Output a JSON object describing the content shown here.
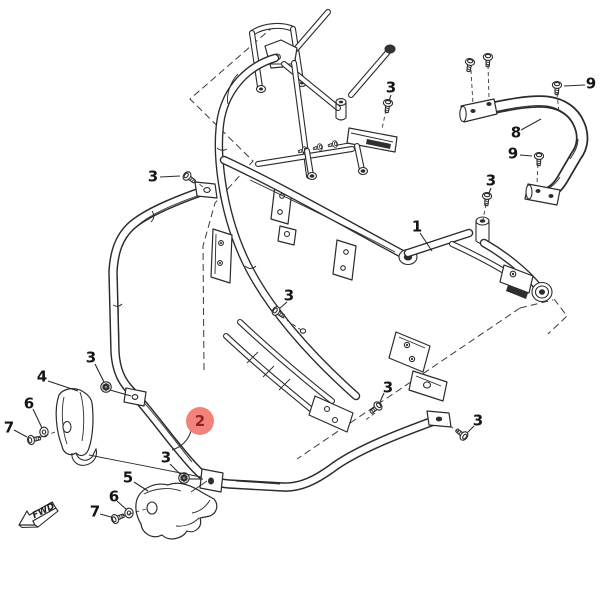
{
  "diagram": {
    "kind": "exploded-parts-diagram",
    "description": "Vehicle frame and front bumper exploded parts diagram",
    "background_color": "#ffffff",
    "line_color": "#2b2b2b",
    "highlight_circle_color": "#f2827b",
    "highlight_text_color": "#8f2323",
    "label_text_color": "#151515"
  },
  "fwd_arrow": {
    "label": "FWD"
  },
  "highlighted_part": "2",
  "callouts": [
    {
      "id": "1",
      "label": "1",
      "x": 417,
      "y": 227,
      "highlighted": false
    },
    {
      "id": "2",
      "label": "2",
      "x": 200,
      "y": 421,
      "highlighted": true
    },
    {
      "id": "3a",
      "label": "3",
      "x": 153,
      "y": 177,
      "highlighted": false
    },
    {
      "id": "3b",
      "label": "3",
      "x": 391,
      "y": 88,
      "highlighted": false
    },
    {
      "id": "3c",
      "label": "3",
      "x": 289,
      "y": 296,
      "highlighted": false
    },
    {
      "id": "3d",
      "label": "3",
      "x": 91,
      "y": 358,
      "highlighted": false
    },
    {
      "id": "3e",
      "label": "3",
      "x": 166,
      "y": 458,
      "highlighted": false
    },
    {
      "id": "3f",
      "label": "3",
      "x": 388,
      "y": 388,
      "highlighted": false
    },
    {
      "id": "3g",
      "label": "3",
      "x": 478,
      "y": 421,
      "highlighted": false
    },
    {
      "id": "3h",
      "label": "3",
      "x": 491,
      "y": 181,
      "highlighted": false
    },
    {
      "id": "4",
      "label": "4",
      "x": 42,
      "y": 377,
      "highlighted": false
    },
    {
      "id": "5",
      "label": "5",
      "x": 128,
      "y": 478,
      "highlighted": false
    },
    {
      "id": "6a",
      "label": "6",
      "x": 29,
      "y": 404,
      "highlighted": false
    },
    {
      "id": "6b",
      "label": "6",
      "x": 114,
      "y": 497,
      "highlighted": false
    },
    {
      "id": "7a",
      "label": "7",
      "x": 9,
      "y": 428,
      "highlighted": false
    },
    {
      "id": "7b",
      "label": "7",
      "x": 95,
      "y": 512,
      "highlighted": false
    },
    {
      "id": "8",
      "label": "8",
      "x": 516,
      "y": 133,
      "highlighted": false
    },
    {
      "id": "9a",
      "label": "9",
      "x": 591,
      "y": 84,
      "highlighted": false
    },
    {
      "id": "9b",
      "label": "9",
      "x": 513,
      "y": 154,
      "highlighted": false
    }
  ]
}
